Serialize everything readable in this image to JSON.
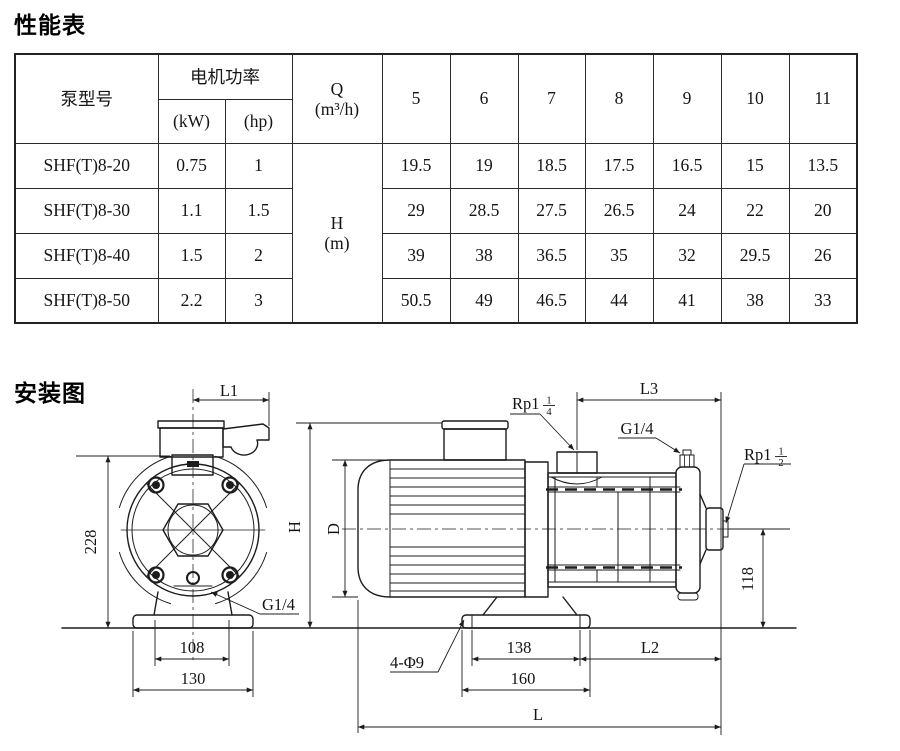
{
  "performance": {
    "title": "性能表",
    "header": {
      "model": "泵型号",
      "power": "电机功率",
      "kw": "(kW)",
      "hp": "(hp)",
      "q_label": "Q",
      "q_unit": "(m³/h)",
      "flows": [
        "5",
        "6",
        "7",
        "8",
        "9",
        "10",
        "11"
      ],
      "h_label": "H",
      "h_unit": "(m)"
    },
    "rows": [
      {
        "model": "SHF(T)8-20",
        "kw": "0.75",
        "hp": "1",
        "values": [
          "19.5",
          "19",
          "18.5",
          "17.5",
          "16.5",
          "15",
          "13.5"
        ]
      },
      {
        "model": "SHF(T)8-30",
        "kw": "1.1",
        "hp": "1.5",
        "values": [
          "29",
          "28.5",
          "27.5",
          "26.5",
          "24",
          "22",
          "20"
        ]
      },
      {
        "model": "SHF(T)8-40",
        "kw": "1.5",
        "hp": "2",
        "values": [
          "39",
          "38",
          "36.5",
          "35",
          "32",
          "29.5",
          "26"
        ]
      },
      {
        "model": "SHF(T)8-50",
        "kw": "2.2",
        "hp": "3",
        "values": [
          "50.5",
          "49",
          "46.5",
          "44",
          "41",
          "38",
          "33"
        ]
      }
    ]
  },
  "installation": {
    "title": "安装图",
    "dims": {
      "l1": "L1",
      "l3": "L3",
      "l2": "L2",
      "l": "L",
      "h": "H",
      "d": "D",
      "v228": "228",
      "v118": "118",
      "v108": "108",
      "v130": "130",
      "v138": "138",
      "v160": "160",
      "holes": "4-Φ9",
      "g14_front": "G1/4",
      "g14_side": "G1/4",
      "rp114": {
        "prefix": "Rp1",
        "num": "1",
        "den": "4"
      },
      "rp112": {
        "prefix": "Rp1",
        "num": "1",
        "den": "2"
      }
    }
  }
}
